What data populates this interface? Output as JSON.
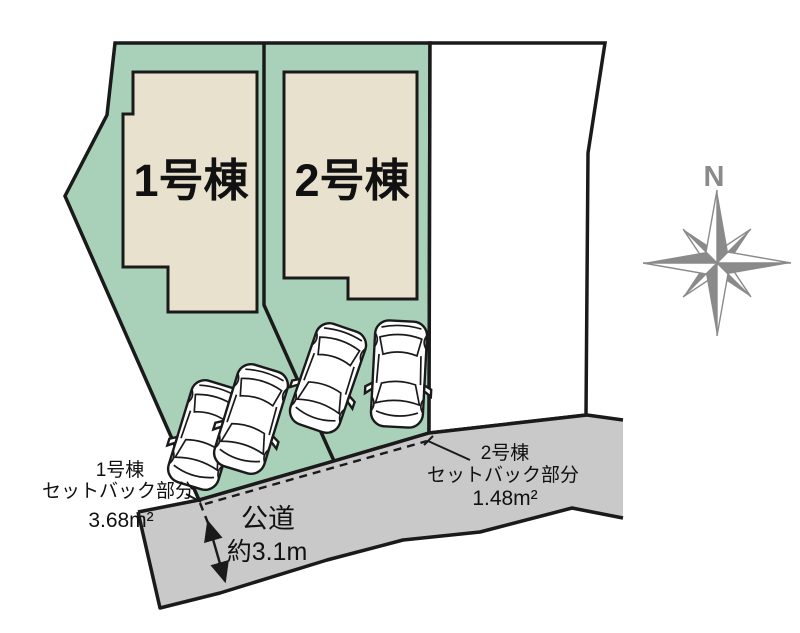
{
  "plan": {
    "buildings": [
      {
        "label": "1号棟"
      },
      {
        "label": "2号棟"
      }
    ],
    "annotations": {
      "setback1_line1": "1号棟",
      "setback1_line2": "セットバック部分",
      "setback1_line3": "3.68m²",
      "setback2_line1": "2号棟",
      "setback2_line2": "セットバック部分",
      "setback2_line3": "1.48m²",
      "road_name": "公道",
      "road_width": "約3.1m"
    },
    "compass": {
      "north_label": "N"
    },
    "colors": {
      "parcel_green": "#a9d1ba",
      "building_beige": "#e8e1ce",
      "road_gray": "#c9c9c9",
      "outline_black": "#1a1a1a",
      "compass_gray": "#8a8a8a"
    }
  }
}
